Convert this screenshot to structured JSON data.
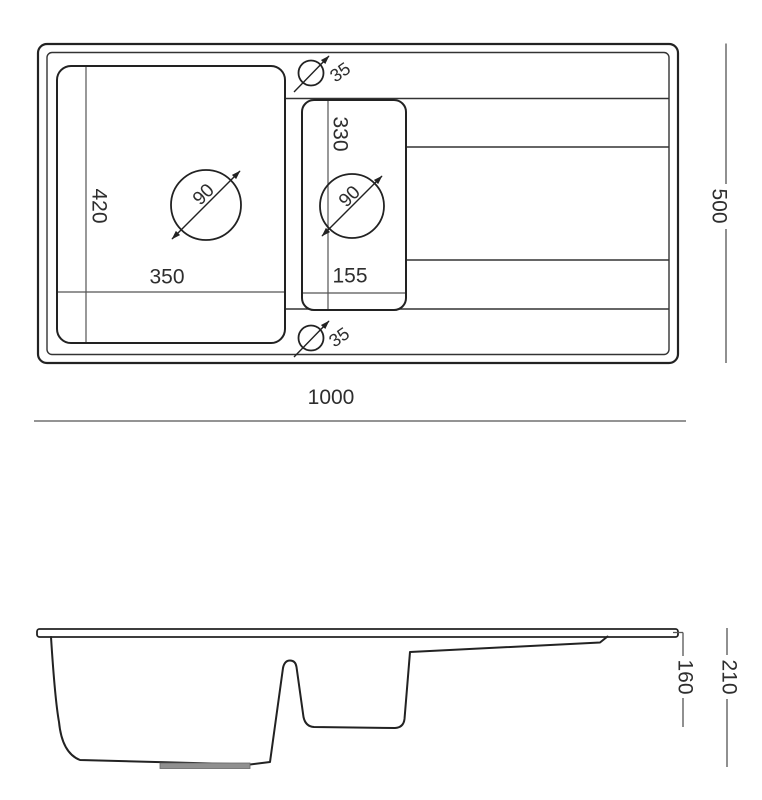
{
  "top_view": {
    "overall_width": "1000",
    "overall_depth": "500",
    "main_bowl": {
      "width": "350",
      "depth": "420",
      "drain_diameter": "90"
    },
    "second_bowl": {
      "width": "155",
      "depth": "330",
      "drain_diameter": "90"
    },
    "tap_hole_top_diameter": "35",
    "tap_hole_bottom_diameter": "35"
  },
  "side_view": {
    "overall_depth": "210",
    "second_bowl_depth": "160"
  },
  "colors": {
    "line": "#222222",
    "dim_line": "#555555",
    "text": "#2e2e2e",
    "drain_fill": "#909090",
    "background": "#ffffff"
  }
}
